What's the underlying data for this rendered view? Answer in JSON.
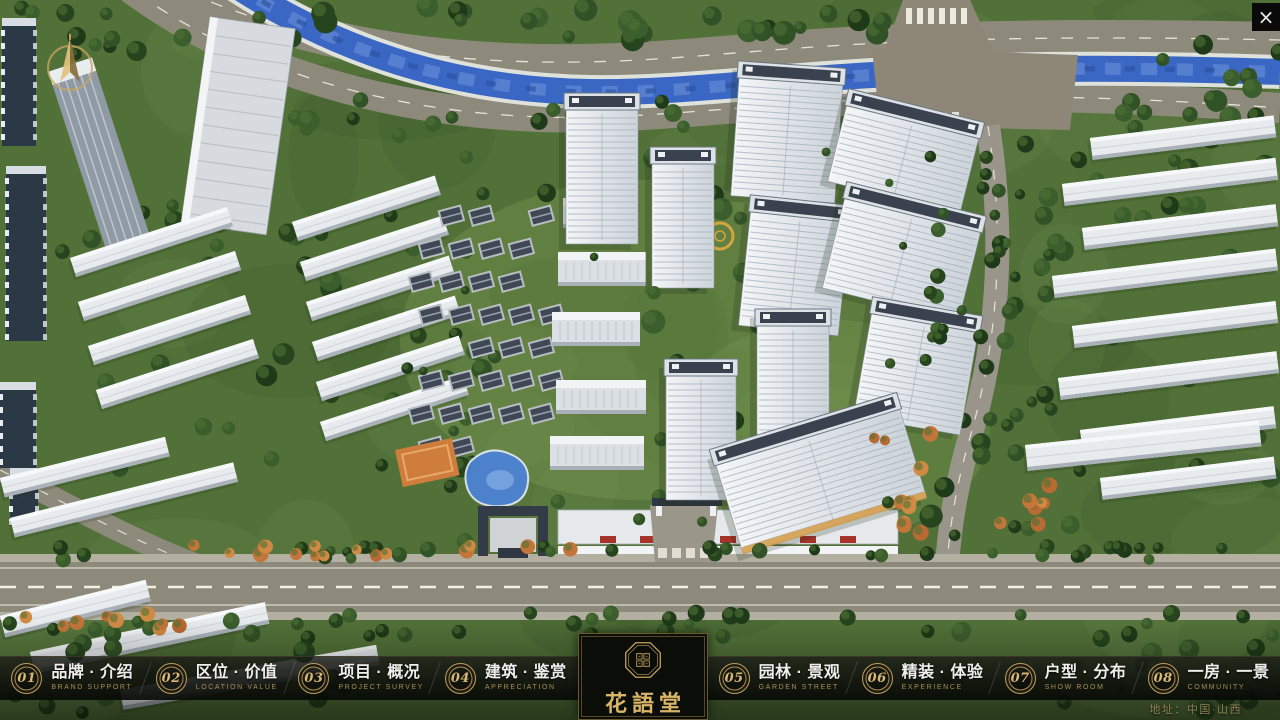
{
  "window": {
    "close_icon": "×"
  },
  "overlay": {
    "address": "地址：中国·山西"
  },
  "logo": {
    "title": "花語堂",
    "subtitle": "FLOWER LANGUAGE HALL"
  },
  "nav": {
    "items": [
      {
        "number": "01",
        "label": "品牌 · 介绍",
        "sub": "BRAND SUPPORT"
      },
      {
        "number": "02",
        "label": "区位 · 价值",
        "sub": "LOCATION VALUE"
      },
      {
        "number": "03",
        "label": "项目 · 概况",
        "sub": "PROJECT SURVEY"
      },
      {
        "number": "04",
        "label": "建筑 · 鉴赏",
        "sub": "APPRECIATION"
      },
      {
        "number": "05",
        "label": "园林 · 景观",
        "sub": "GARDEN STREET"
      },
      {
        "number": "06",
        "label": "精装 · 体验",
        "sub": "EXPERIENCE"
      },
      {
        "number": "07",
        "label": "户型 · 分布",
        "sub": "SHOW ROOM"
      },
      {
        "number": "08",
        "label": "一房 · 一景",
        "sub": "COMMUNITY"
      }
    ]
  },
  "colors": {
    "gold": "#c9a55f",
    "river": "#3a67c4",
    "nav_bg": "#0a0c08"
  }
}
